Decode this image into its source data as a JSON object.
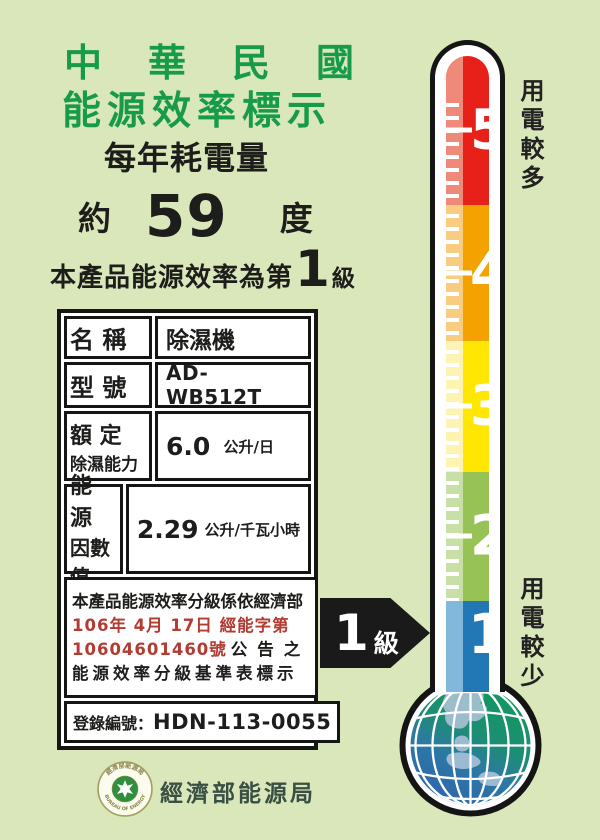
{
  "header": {
    "title_line1": "中華民國",
    "title_line2": "能源效率標示",
    "subtitle": "每年耗電量"
  },
  "consumption": {
    "prefix": "約",
    "value": "59",
    "unit": "度"
  },
  "grade": {
    "before": "本產品能源效率為第",
    "value": "1",
    "after": "級"
  },
  "spec_table": {
    "rows": [
      {
        "label": "名 稱",
        "value": "除濕機"
      },
      {
        "label": "型 號",
        "value": "AD-WB512T"
      },
      {
        "label_line1": "額 定",
        "label_line2": "除濕能力",
        "value": "6.0",
        "unit": "公升/日"
      },
      {
        "label_line1": "能 源",
        "label_line2": "因數值",
        "value": "2.29",
        "unit": "公升/千瓦小時"
      }
    ],
    "notice": {
      "line1": "本產品能源效率分級係依經濟部",
      "line2_red": "106年 4月 17日 經能字第",
      "line3_red": "10604601460號",
      "line3_black": "公告之",
      "line4": "能源效率分級基準表標示"
    },
    "registration": {
      "label": "登錄編號：",
      "value": "HDN-113-0055"
    }
  },
  "footer": {
    "seal_top_text": "經濟部能源局",
    "seal_bottom_text": "BUREAU OF ENERGY",
    "agency": "經濟部能源局"
  },
  "thermometer": {
    "top_label": "用電較多",
    "bottom_label": "用電較少",
    "levels": [
      {
        "num": "5",
        "color": "#e7211a",
        "stripe": "#ef8a7b"
      },
      {
        "num": "4",
        "color": "#f3a200",
        "stripe": "#f8cd80"
      },
      {
        "num": "3",
        "color": "#ffe603",
        "stripe": "#fdf3b3"
      },
      {
        "num": "2",
        "color": "#97c255",
        "stripe": "#c8e0a5"
      },
      {
        "num": "1",
        "color": "#2278b5",
        "stripe": "#82b8dc"
      }
    ],
    "arrow_num": "1",
    "arrow_suffix": "級"
  },
  "colors": {
    "background": "#d9e7ba",
    "title_green": "#179b4b",
    "notice_red": "#b23b32",
    "arrow_black": "#1a1a1a",
    "globe_green": "#0c9c58",
    "globe_blue": "#2f5fb0"
  }
}
